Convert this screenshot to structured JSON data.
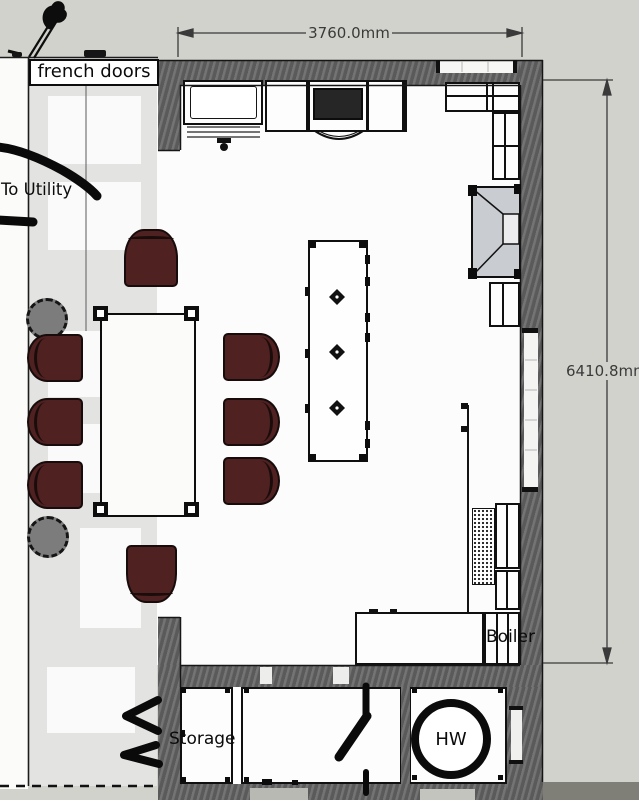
{
  "labels": {
    "french_doors": "french doors",
    "to_utility": "To Utility",
    "storage": "Storage",
    "boiler": "Boiler",
    "hot_water": "HW"
  },
  "dimensions": {
    "width": "3760.0mm",
    "height": "6410.8mm"
  },
  "colors": {
    "background": "#d2d2cd",
    "dining_floor": "#e3e3e1",
    "kitchen_floor": "#fcfcfc",
    "wall": "#646464",
    "chair_upholstery": "#4f2121",
    "hob": "#262626",
    "appliance_gray": "#c9ccd1",
    "dimension_line": "#3a3a3a"
  }
}
